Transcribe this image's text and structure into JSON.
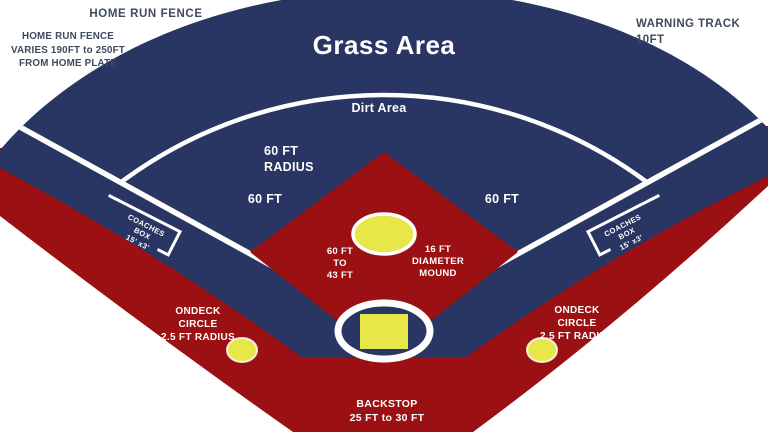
{
  "diagram_title": "Baseball field dimensions diagram",
  "colors": {
    "navy": "#293562",
    "red": "#9B1013",
    "yellow": "#E8E74A",
    "white": "#FFFFFF",
    "label_dark": "#3E4A5E"
  },
  "labels": {
    "home_run_fence_top": "HOME RUN FENCE",
    "home_run_fence_left": "HOME RUN FENCE\nVARIES 190FT to 250FT\nFROM HOME PLATE",
    "warning_track": "WARNING TRACK\n10FT",
    "grass_area": "Grass Area",
    "dirt_area": "Dirt Area",
    "infield_radius": "60 FT\nRADIUS",
    "baseline_left": "60 FT",
    "baseline_right": "60 FT",
    "pitching_distance": "60 FT\nTO\n43 FT",
    "mound": "16 FT\nDIAMETER\nMOUND",
    "coaches_box_left": "COACHES\nBOX\n15' x3'",
    "coaches_box_right": "COACHES\nBOX\n15' x3'",
    "ondeck_left": "ONDECK\nCIRCLE\n2.5 FT RADIUS",
    "ondeck_right": "ONDECK\nCIRCLE\n2.5 FT RADIUS",
    "backstop": "BACKSTOP\n25 FT to 30 FT"
  }
}
